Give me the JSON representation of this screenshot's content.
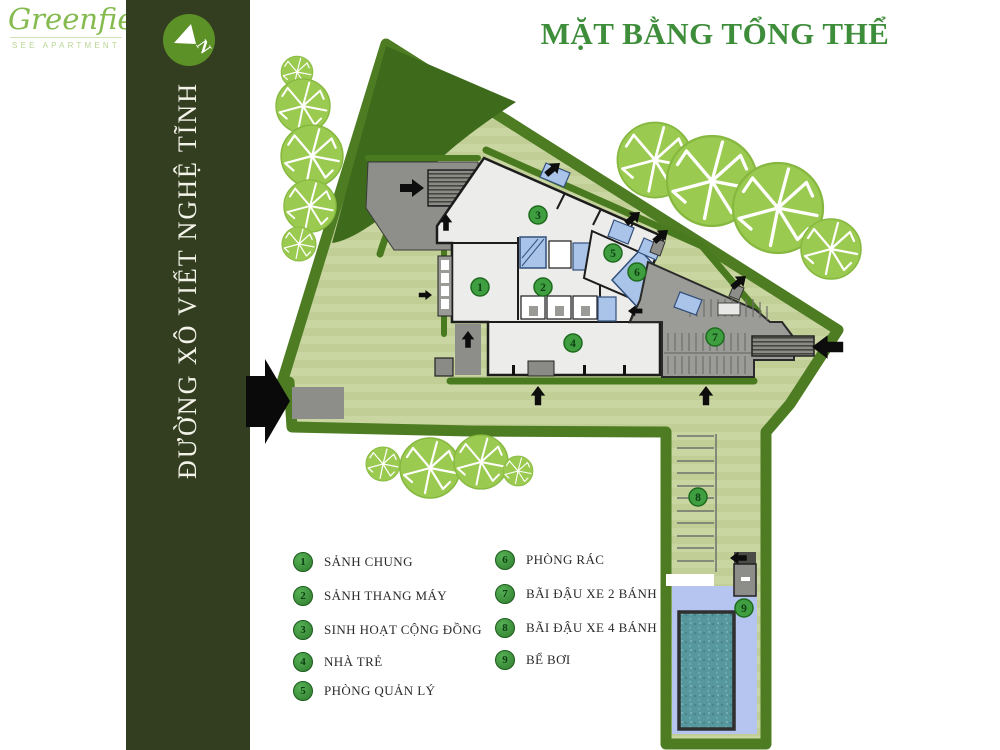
{
  "logo": {
    "brand": "Greenfield",
    "subtitle": "SEE APARTMENT"
  },
  "sidebar": {
    "street_name": "ĐƯỜNG XÔ VIẾT NGHỆ TĨNH",
    "compass_letter": "N"
  },
  "header": {
    "title": "MẶT BẰNG TỔNG THỂ"
  },
  "legend": {
    "items": [
      {
        "num": "1",
        "label": "SẢNH CHUNG"
      },
      {
        "num": "2",
        "label": "SẢNH THANG MÁY"
      },
      {
        "num": "3",
        "label": "SINH HOẠT CỘNG ĐỒNG"
      },
      {
        "num": "4",
        "label": "NHÀ TRẺ"
      },
      {
        "num": "5",
        "label": "PHÒNG QUẢN LÝ"
      },
      {
        "num": "6",
        "label": "PHÒNG RÁC"
      },
      {
        "num": "7",
        "label": "BÃI ĐẬU XE 2 BÁNH"
      },
      {
        "num": "8",
        "label": "BÃI ĐẬU XE 4 BÁNH"
      },
      {
        "num": "9",
        "label": "BỂ BƠI"
      }
    ]
  },
  "colors": {
    "bar_bg": "#333d1f",
    "brand_green": "#84ba4e",
    "title_green": "#3e8d3a",
    "lawn": "#c9d6a2",
    "hedge_green": "#4a7a20",
    "tree_green": "#9bca50",
    "building_fill": "#ececea",
    "parking_gray": "#9b9c98",
    "glass_blue": "#a9c4e8",
    "deck_blue": "#b6c5ef",
    "pool_teal": "#57989f"
  }
}
